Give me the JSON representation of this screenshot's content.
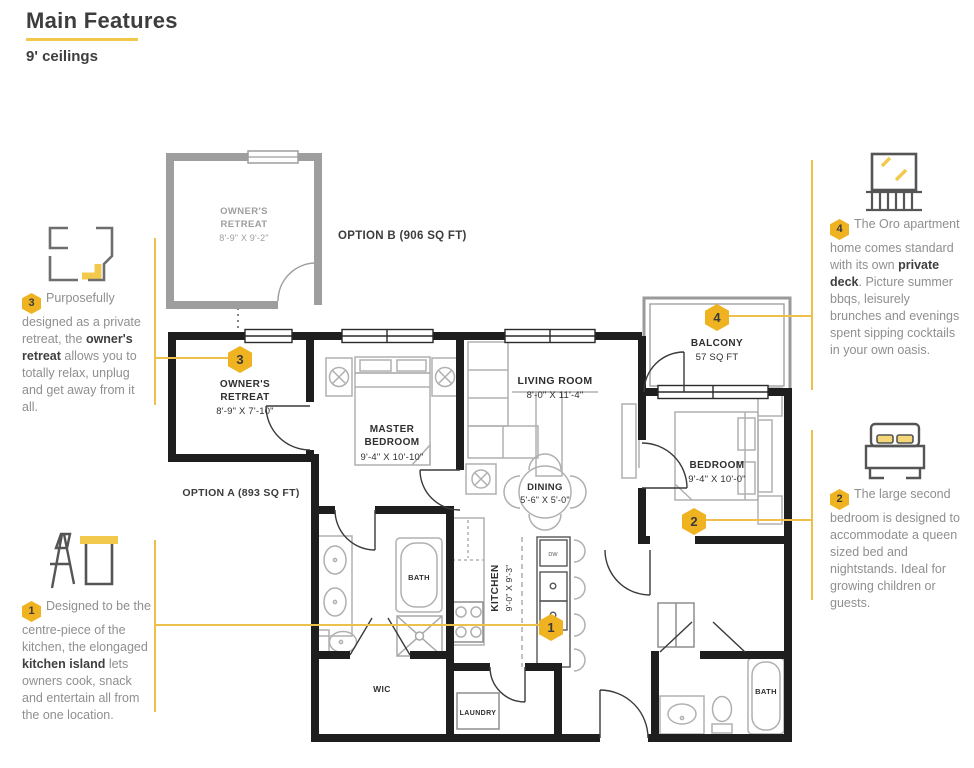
{
  "header": {
    "title": "Main Features",
    "subtitle": "9' ceilings"
  },
  "colors": {
    "accent_gold": "#EFB321",
    "underline_yellow": "#F2C84B",
    "line_yellow": "#ECC04A",
    "text_dark": "#3d3d3d",
    "text_gray": "#8f8f8f",
    "wall_black": "#1e1e1e",
    "wall_gray": "#9e9e9e"
  },
  "annotations": {
    "a1": {
      "number": "1",
      "icon": "kitchen-island-icon",
      "seg1": "Designed to be the centre-piece of the kitchen, the elongaged ",
      "bold": "kitchen island",
      "seg2": " lets owners cook, snack and entertain all from the one location."
    },
    "a2": {
      "number": "2",
      "icon": "bed-icon",
      "seg1": "The large second bedroom is designed to accommodate a queen sized bed and nightstands. Ideal for growing children or guests.",
      "bold": "",
      "seg2": ""
    },
    "a3": {
      "number": "3",
      "icon": "retreat-plan-icon",
      "seg1": "Purposefully designed as a private retreat, the ",
      "bold": "owner's retreat",
      "seg2": " allows you to totally relax, unplug and get away from it all."
    },
    "a4": {
      "number": "4",
      "icon": "balcony-icon",
      "seg1": "The Oro apartment home comes standard with its own ",
      "bold": "private deck",
      "seg2": ". Picture summer bbqs, leisurely brunches and evenings spent sipping cocktails in your own oasis."
    }
  },
  "plan": {
    "option_b": {
      "name_line1": "OWNER'S",
      "name_line2": "RETREAT",
      "dims": "8'-9\" X 9'-2\"",
      "label": "OPTION B (906 SQ FT)"
    },
    "option_a_label": "OPTION A (893 SQ FT)",
    "owners_retreat": {
      "number": "3",
      "name_line1": "OWNER'S",
      "name_line2": "RETREAT",
      "dims": "8'-9\" X 7'-10\""
    },
    "master_bedroom": {
      "name_line1": "MASTER",
      "name_line2": "BEDROOM",
      "dims": "9'-4\" X 10'-10\""
    },
    "living_room": {
      "name": "LIVING ROOM",
      "dims": "8'-0\" X 11'-4\""
    },
    "dining": {
      "name": "DINING",
      "dims": "5'-6\" X 5'-0\""
    },
    "kitchen": {
      "number": "1",
      "name": "KITCHEN",
      "dims": "9'-0\" X 9'-3\""
    },
    "bedroom": {
      "number": "2",
      "name": "BEDROOM",
      "dims": "9'-4\" X 10'-0\""
    },
    "balcony": {
      "number": "4",
      "name": "BALCONY",
      "dims": "57 SQ FT"
    },
    "master_bath": "BATH",
    "second_bath": "BATH",
    "wic": "WIC",
    "laundry": "LAUNDRY",
    "dishwasher": "DW"
  }
}
